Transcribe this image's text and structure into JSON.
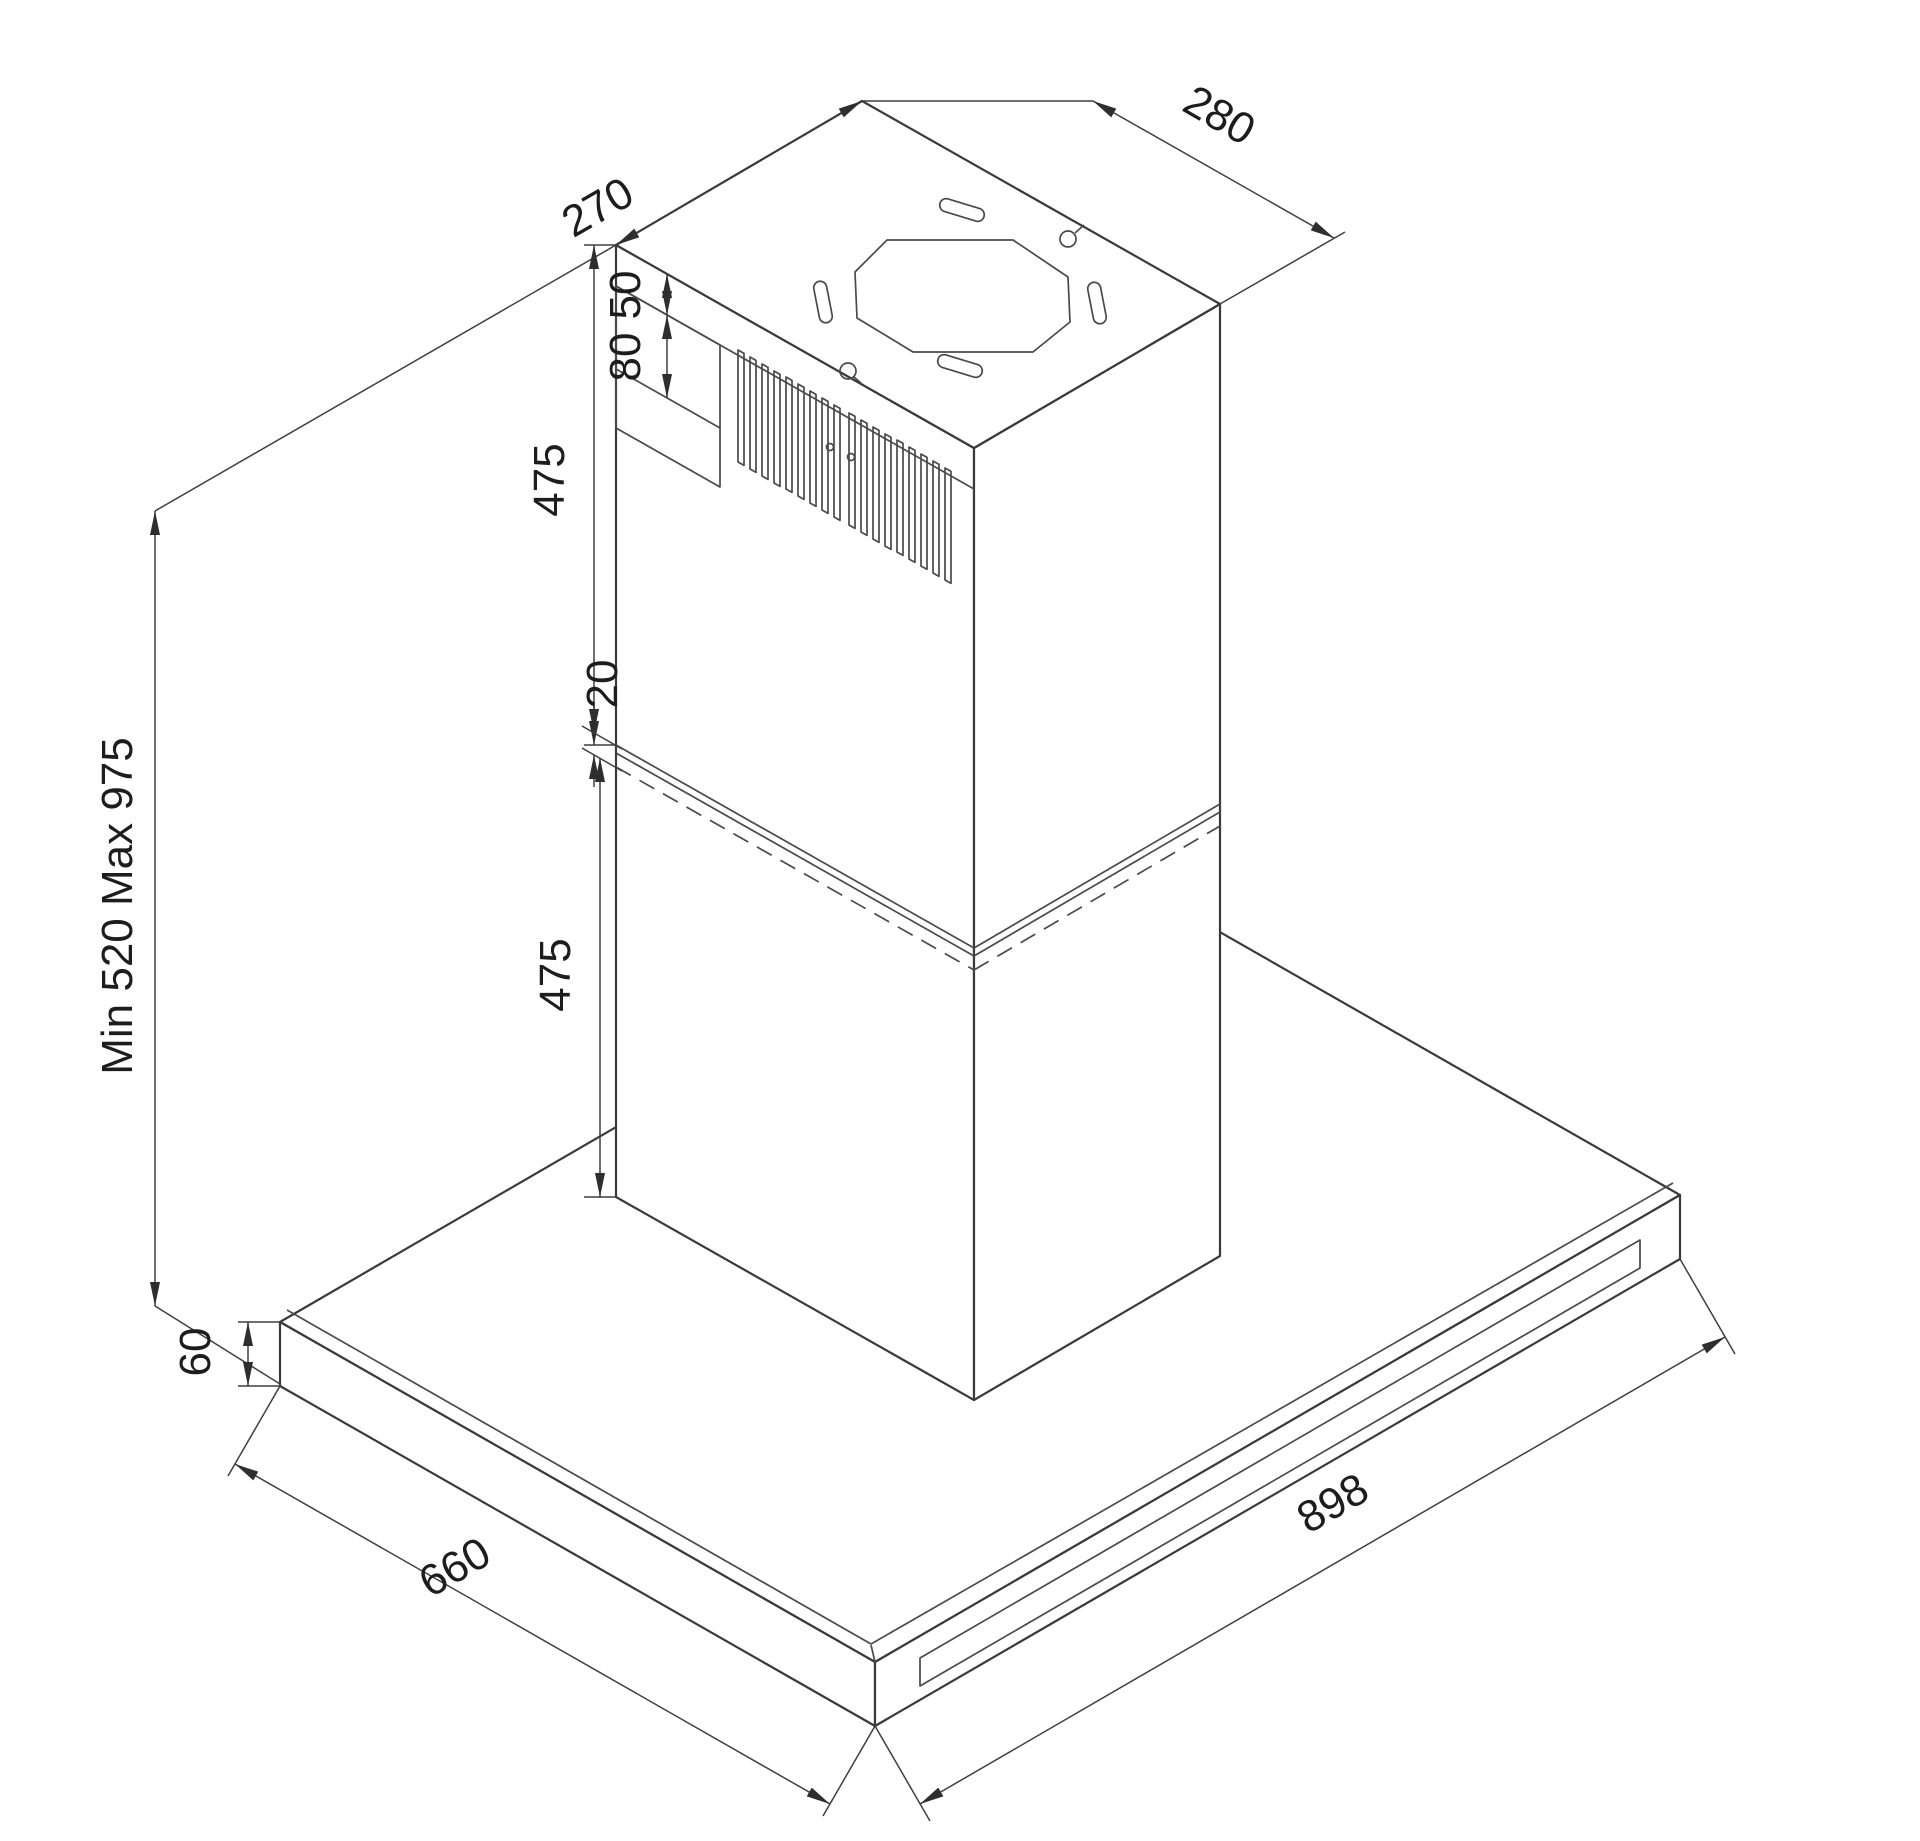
{
  "drawing": {
    "type": "technical-isometric-diagram",
    "subject": "island range hood installation dimensions (mm)",
    "dimensions": {
      "chimney_top_depth": "270",
      "chimney_top_width": "280",
      "top_collar_height": "50",
      "mounting_bracket_height": "80",
      "upper_chimney_height": "475",
      "chimney_overlap": "20",
      "lower_chimney_height": "475",
      "installation_height_range": "Min 520 Max 975",
      "hood_body_height": "60",
      "hood_body_depth": "660",
      "hood_body_width": "898"
    }
  }
}
